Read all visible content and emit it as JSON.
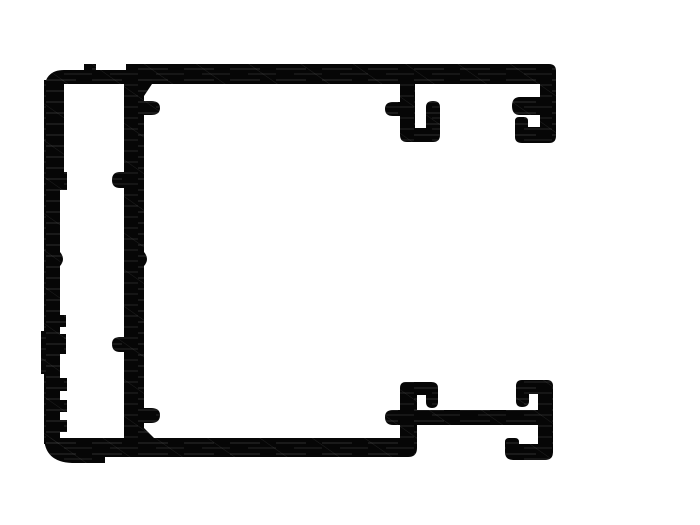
{
  "drawing": {
    "description": "cad-cross-section-of-aluminum-extrusion-profile",
    "canvas": {
      "width": 700,
      "height": 525,
      "background": "#ffffff"
    },
    "ink_color": "#060606",
    "texture": {
      "streak_color": "#6f6f6f",
      "streak_opacity": 0.3,
      "hatch_color": "#9a9a9a",
      "hatch_opacity": 0.22
    },
    "parts": [
      {
        "name": "top-bar",
        "path": "M 44 92 Q 44 70 64 70 L 84 70 L 84 64 L 96 64 L 96 70 L 126 70 L 126 64 L 549 64 Q 556 64 556 71 L 556 84 L 44 84 Z"
      },
      {
        "name": "outer-left-wall",
        "path": "M 44 80 L 64 80 L 64 172 L 67 172 L 67 190 L 60 190 L 60 252 Q 66 259 60 266 L 60 315 L 66 315 L 66 327 L 60 327 L 60 334 L 66 334 L 66 354 L 60 354 L 60 378 L 67 378 L 67 391 L 60 391 L 60 400 L 67 400 L 67 412 L 60 412 L 60 420 L 67 420 L 67 432 L 60 432 L 60 444 L 44 444 L 44 374 L 41 374 L 41 331 L 44 331 Z"
      },
      {
        "name": "bottom-bar",
        "path": "M 47 438 L 417 438 L 417 448 Q 417 457 408 457 L 105 457 L 105 463 L 72 463 Q 44 462 44 436 Z"
      },
      {
        "name": "inner-wall",
        "path": "M 124 78 L 152 78 L 152 84 L 144 96 L 144 101 L 151 101 Q 160 101 160 108 Q 160 115 151 115 L 144 115 L 144 252 Q 150 259 144 266 L 144 408 L 151 408 Q 160 408 160 415 Q 160 423 151 423 L 144 423 L 144 428 L 156 440 L 124 440 L 124 352 L 120 352 Q 112 352 112 344 Q 112 337 120 337 L 124 337 L 124 188 L 120 188 Q 112 188 112 180 Q 112 172 120 172 L 124 172 Z"
      },
      {
        "name": "top-hook-left",
        "path": "M 400 80 L 415 80 L 415 128 L 426 128 L 426 107 Q 426 101 433 101 Q 440 101 440 107 L 440 135 Q 440 142 433 142 L 407 142 Q 400 142 400 135 L 400 116 L 393 116 Q 385 116 385 109 Q 385 102 393 102 L 400 102 Z"
      },
      {
        "name": "top-hook-right",
        "path": "M 540 80 L 556 80 L 556 136 Q 556 143 549 143 L 522 143 Q 515 143 515 137 L 515 121 Q 515 117 519 117 L 524 117 Q 528 117 528 121 L 528 127 L 540 127 L 540 115 L 520 115 Q 512 115 512 106 Q 512 97 520 97 L 540 97 Z"
      },
      {
        "name": "bottom-stem-hook",
        "path": "M 400 440 L 400 388 Q 400 382 406 382 L 431 382 Q 438 382 438 388 L 438 402 Q 438 408 432 408 Q 426 408 426 402 L 426 395 L 417 395 L 417 440 Z"
      },
      {
        "name": "bottom-mid-bar",
        "path": "M 393 410 L 553 410 L 553 425 L 393 425 Q 385 425 385 417 Q 385 410 393 410 Z"
      },
      {
        "name": "bottom-right-wall-upper-hook",
        "path": "M 538 410 L 538 394 L 529 394 L 529 401 Q 529 407 522 407 Q 516 407 516 401 L 516 386 Q 516 380 522 380 L 547 380 Q 553 380 553 386 L 553 410 Z"
      },
      {
        "name": "bottom-right-wall-lower-hook",
        "path": "M 538 425 L 553 425 L 553 452 Q 553 460 545 460 L 513 460 Q 505 460 505 452 L 505 442 Q 505 438 509 438 L 515 438 Q 519 438 519 442 L 519 444 L 538 444 Z"
      }
    ]
  }
}
